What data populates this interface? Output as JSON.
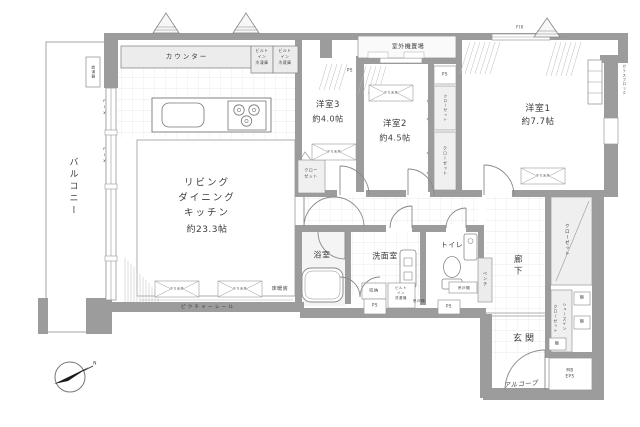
{
  "plan": {
    "balcony": "バルコニー",
    "ldk": {
      "l1": "リビング",
      "l2": "ダイニング",
      "l3": "キッチン",
      "size": "約23.3帖"
    },
    "room3": {
      "name": "洋室3",
      "size": "約4.0帖"
    },
    "room2": {
      "name": "洋室2",
      "size": "約4.5帖"
    },
    "room1": {
      "name": "洋室1",
      "size": "約7.7帖"
    },
    "bath": "浴室",
    "washroom": "洗面室",
    "toilet": "トイレ",
    "hallway": "廊下",
    "entrance": "玄関",
    "alcove": "アルコーブ"
  },
  "fx": {
    "counter": "カウンター",
    "freezer": {
      "l1": "ビルト",
      "l2": "イン",
      "l3": "冷凍庫"
    },
    "fridge": {
      "l1": "ビルト",
      "l2": "イン",
      "l3": "冷蔵庫"
    },
    "outdoor": "室外機置場",
    "heater": "給湯器",
    "fix": "FIX",
    "ps": "PS",
    "glass": "ガラスブロック",
    "closet": "クローゼット",
    "closet2": {
      "l1": "クロー",
      "l2": "ゼット"
    },
    "shoes1": "シューズイン",
    "shoes2": "クローゼット",
    "shelf": "棚",
    "storage": "収納",
    "washer": {
      "l1": "ビルト",
      "l2": "イン",
      "l3": "洗濯機"
    },
    "cupboard": "吊戸棚",
    "bench": "ベンチ",
    "mb": "MB",
    "eps": "EPS",
    "heating": "床暖房",
    "rail": "ピクチャーレール",
    "beam": "下り天井",
    "north": "N"
  },
  "colors": {
    "wall": "#9c9c9c",
    "lightfill": "#ececec",
    "line": "#8a8a8a"
  }
}
